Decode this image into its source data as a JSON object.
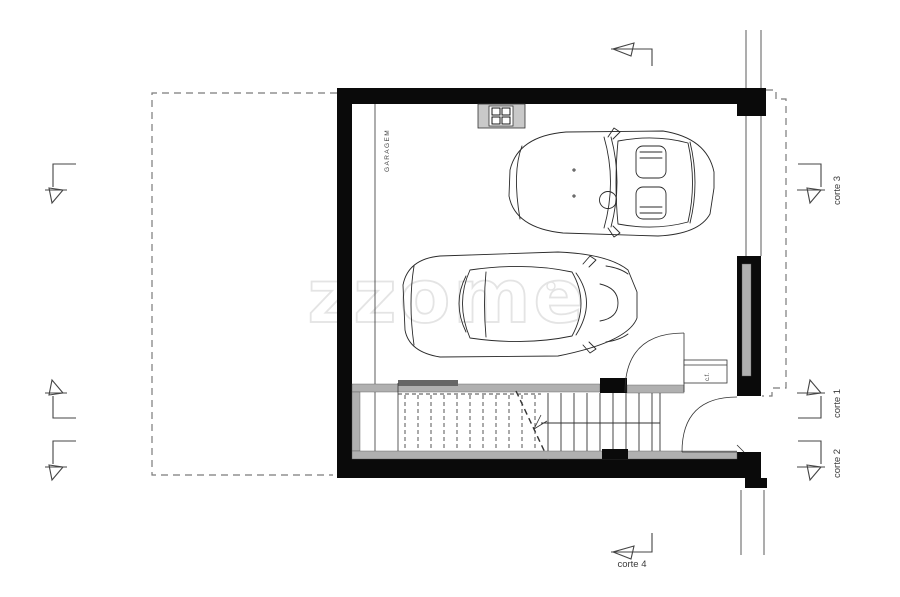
{
  "plan": {
    "room_label": "GARAGEM",
    "closet_label": "c.f.",
    "watermark": "zzome",
    "sections": {
      "corte1": "corte 1",
      "corte2": "corte 2",
      "corte3": "corte 3",
      "corte4": "corte 4"
    },
    "colors": {
      "wall": "#0a0a0a",
      "gray_band": "#b0b0b0",
      "line": "#333333",
      "dashed": "#7a7a7a",
      "watermark": "#e4e4e4",
      "label": "#3a3a3a"
    }
  }
}
